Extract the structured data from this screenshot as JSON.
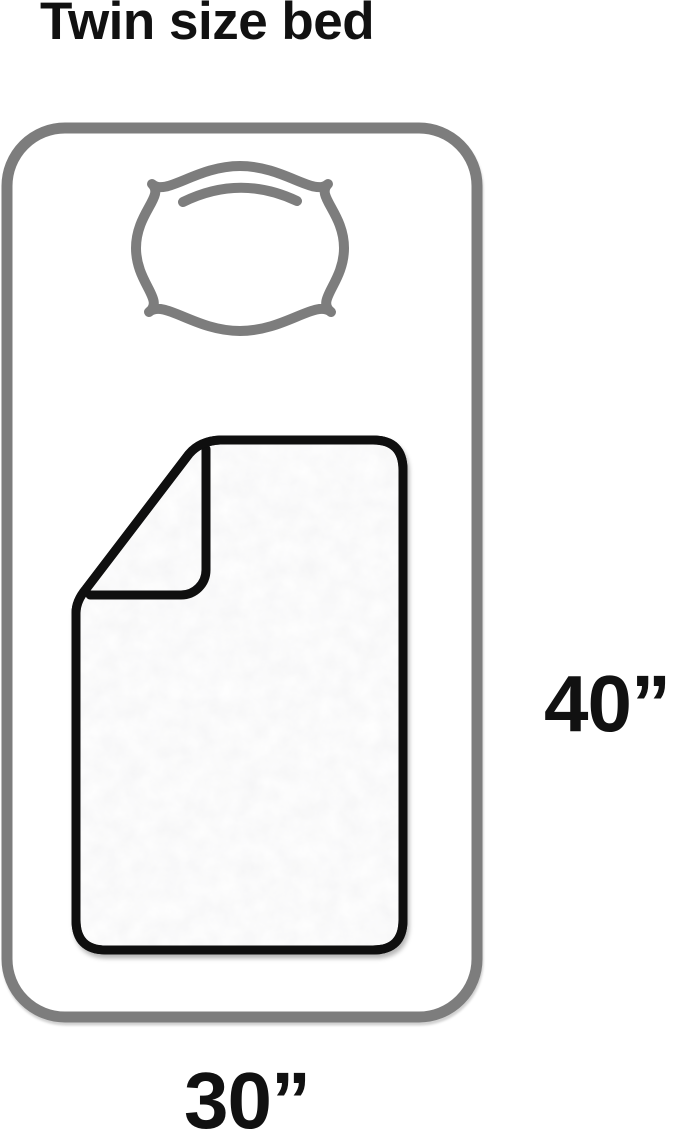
{
  "title": "Twin size bed",
  "dimensions": {
    "height_label": "40”",
    "width_label": "30”"
  },
  "colors": {
    "background": "#ffffff",
    "outline_gray": "#7d7d7d",
    "blanket_black": "#0f0f0f",
    "text_black": "#111111",
    "fill_white": "#ffffff"
  },
  "icons": {
    "bed": "bed-outline-icon",
    "pillow": "pillow-icon",
    "blanket": "blanket-icon"
  }
}
